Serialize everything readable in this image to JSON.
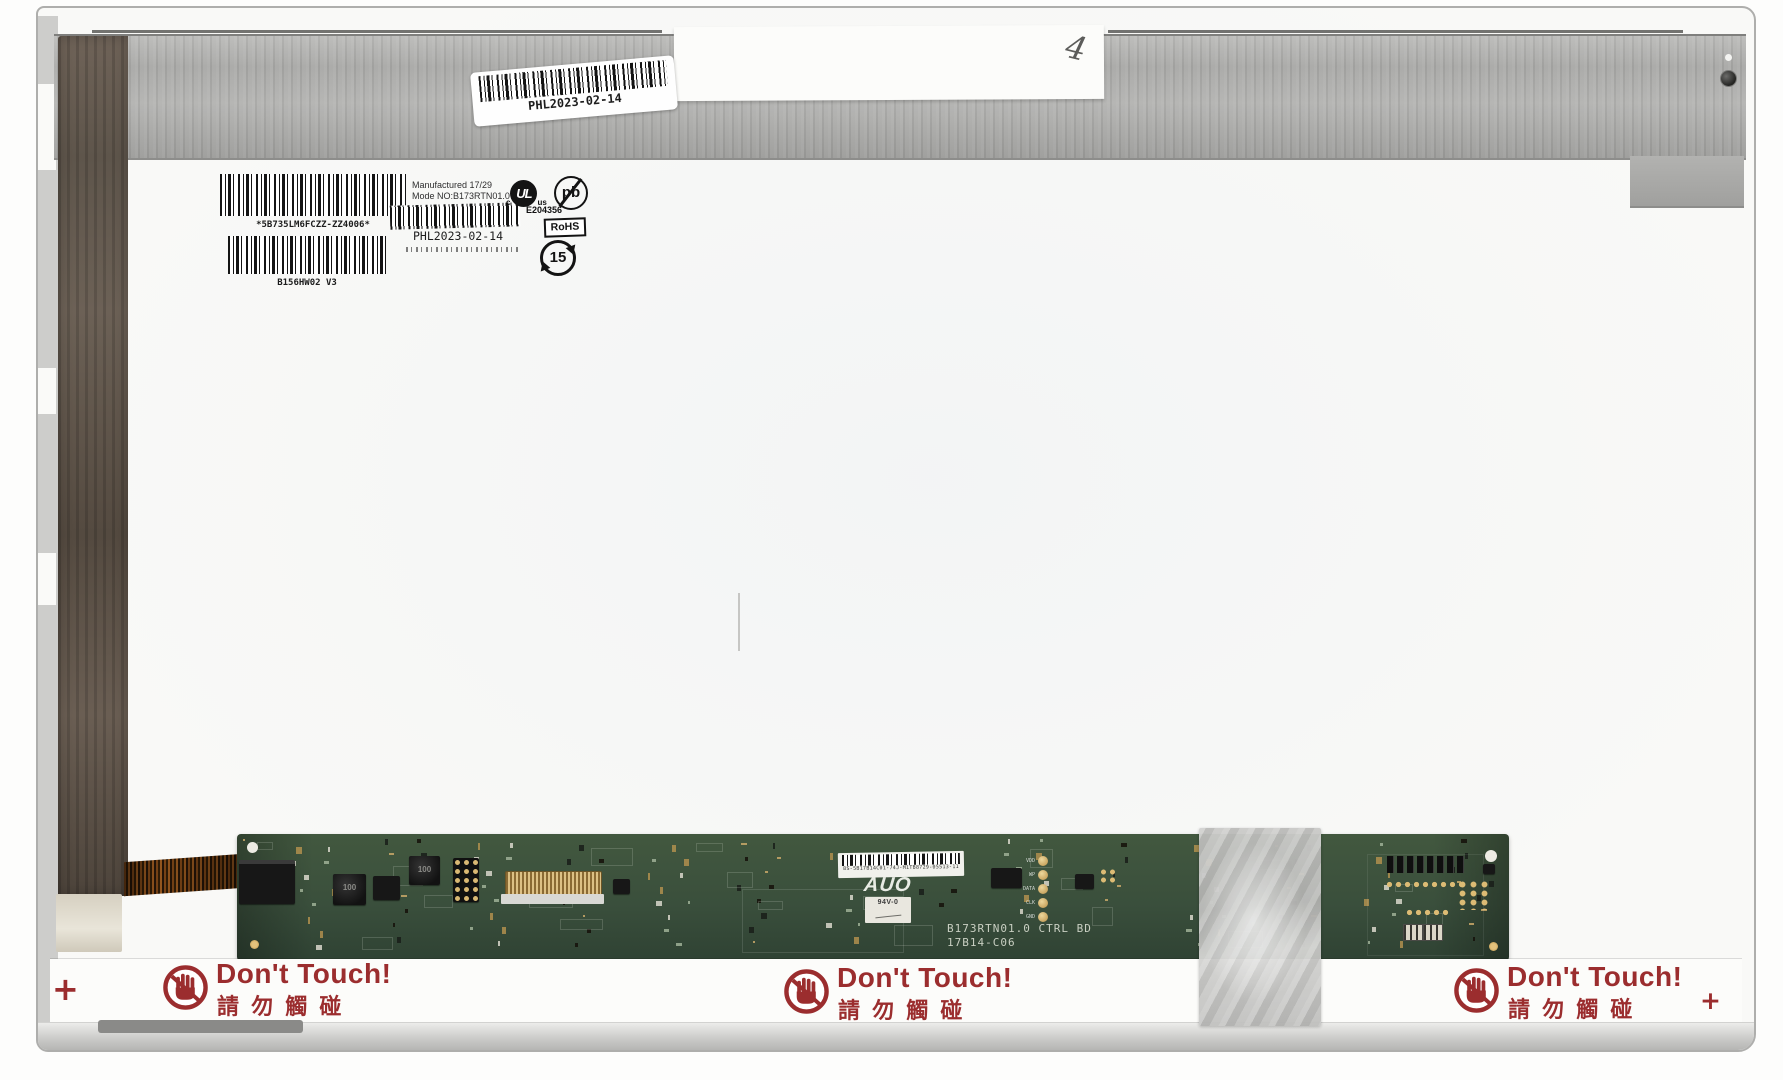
{
  "colors": {
    "warning_red": "#9b2d2e",
    "pcb_green": "#3a4f3c",
    "tape_brown": "#6b5e53",
    "metal_gray": "#ababa9"
  },
  "top_area": {
    "tape_label": {
      "handwritten_mark": "4"
    },
    "metal_sticker": {
      "barcode_caption": "PHL2023-02-14"
    }
  },
  "labels": {
    "serial_sticker": {
      "caption": "*5B735LM6FCZZ-ZZ4006*"
    },
    "model_sticker": {
      "caption": "B156HW02  V3"
    },
    "mfg_sticker": {
      "line1": "Manufactured 17/29",
      "line2": "Mode NO:B173RTN01.0",
      "barcode_caption": "PHL2023-02-14"
    },
    "ul_mark": {
      "left": "c",
      "logo": "UL",
      "right": "us",
      "file_number": "E204356"
    },
    "pb_free_mark": "pb",
    "rohs_mark": "RoHS",
    "recycle_mark": "15"
  },
  "pcb": {
    "sticker_code": "8S-5B17B14C01-74J-M1TB8729-05513-11",
    "brand": "AUO",
    "flammability": "94V-0",
    "board_title": "B173RTN01.0 CTRL BD",
    "board_code": "17B14-C06",
    "inductor_label": "100",
    "testpoints": [
      "VDD",
      "WP",
      "DATA",
      "CLK",
      "GND"
    ]
  },
  "warnings": [
    {
      "title": "Don't Touch!",
      "subtitle": "請 勿 觸 碰"
    },
    {
      "title": "Don't Touch!",
      "subtitle": "請 勿 觸 碰"
    },
    {
      "title": "Don't Touch!",
      "subtitle": "請 勿 觸 碰"
    }
  ],
  "registration_marks": {
    "left": "+",
    "right": "+"
  }
}
